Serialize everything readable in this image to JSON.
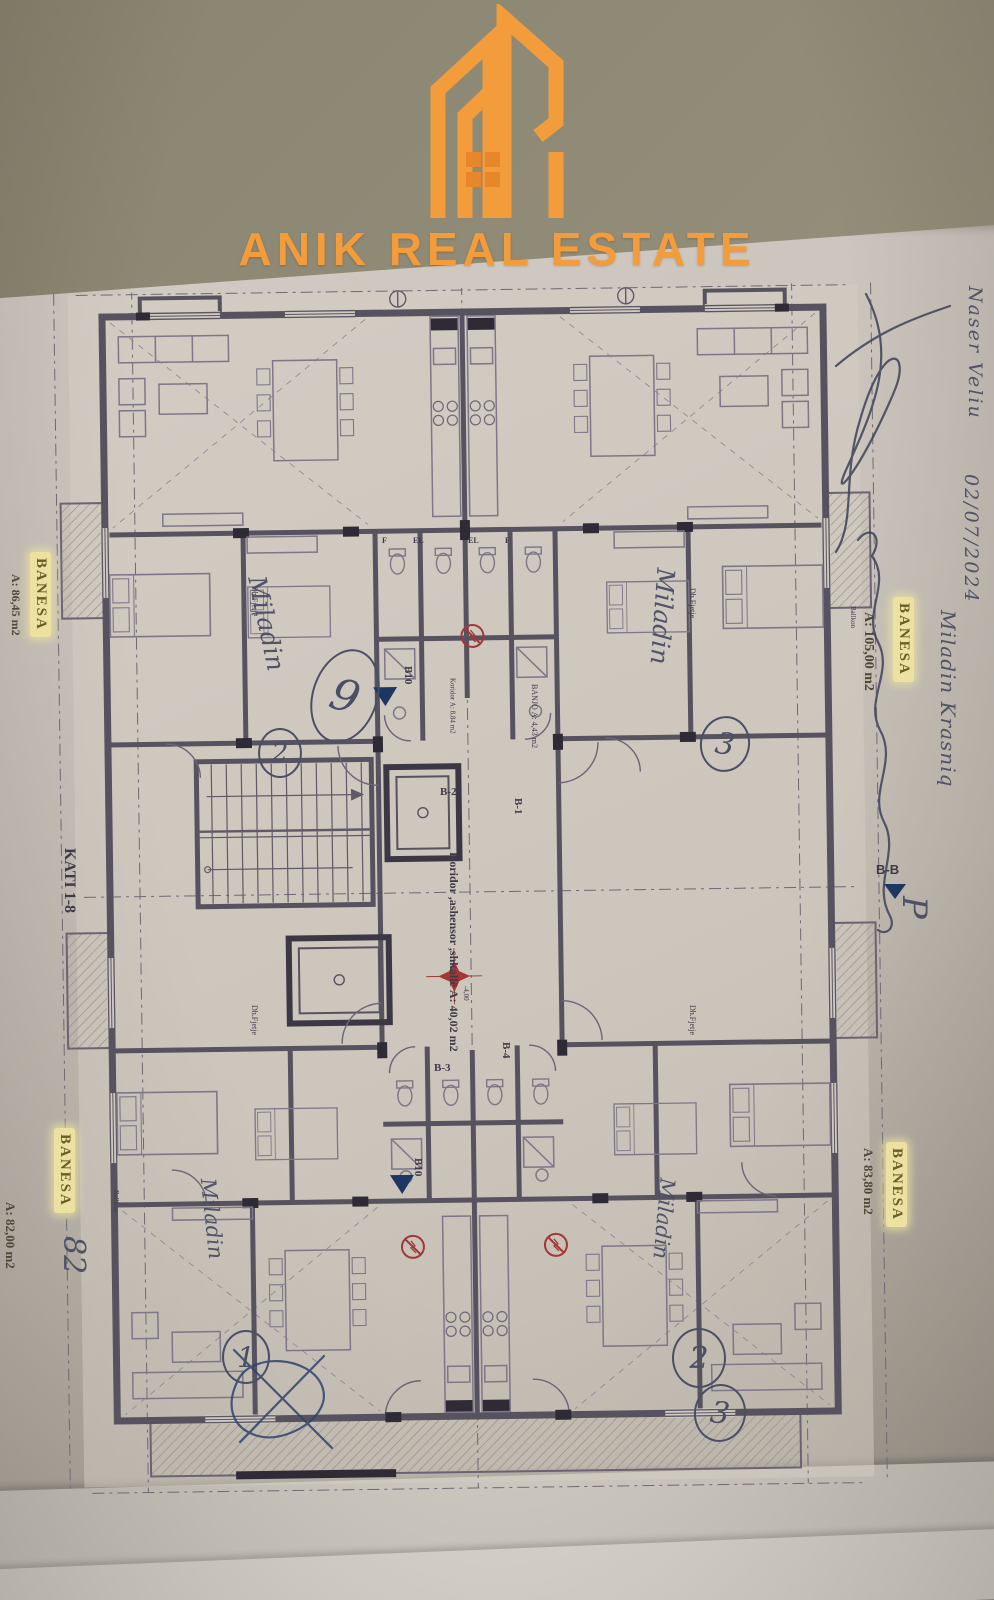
{
  "colors": {
    "accent_orange": "#f29c3c",
    "highlight_yellow": "#ece1a0",
    "ink_blue": "#474b62",
    "plan_line": "#55505e",
    "red_symbol": "#a33636",
    "marker_blue": "#1d3763"
  },
  "logo": {
    "brand": "ANIK REAL ESTATE",
    "icon": "building-towers-icon"
  },
  "plan": {
    "floor_label": "KATI 1-8",
    "core_label": "Koridor ,ashensor ,shkallë",
    "core_area": "A: 40,02 m2",
    "elevation": "-4,00",
    "section_marker": "B-B",
    "balcony_markers": [
      "B10",
      "B10"
    ],
    "bath_markers": [
      "B-1",
      "B-2",
      "B-3",
      "B-4"
    ],
    "rooms": {
      "banjo": "BANJO",
      "banjo_area": "A: 4,43 m2",
      "koridor": "Koridor",
      "koridor_area": "A: 8,84 m2",
      "bedroom": "Dh.Fjetje",
      "balcony": "Ballkon",
      "el": "EL",
      "f": "F"
    },
    "apartments": [
      {
        "position": "top-left",
        "label": "BANESA",
        "area": "A: 86,45 m2"
      },
      {
        "position": "top-right",
        "label": "BANESA",
        "area": "A: 105,00 m2"
      },
      {
        "position": "bottom-left",
        "label": "BANESA",
        "area": "A: 82,00 m2"
      },
      {
        "position": "bottom-right",
        "label": "BANESA",
        "area": "A: 83,80 m2"
      }
    ]
  },
  "handwriting": {
    "name": "Naser Veliu",
    "date": "02/07/2024",
    "owner": "Miladin Krasniq",
    "letter": "P",
    "number": "82",
    "unit_names": [
      "Miladin",
      "Miladin",
      "Miladin",
      "Miladin"
    ],
    "circled_numbers": [
      "2",
      "9",
      "3",
      "1",
      "2",
      "3"
    ]
  }
}
